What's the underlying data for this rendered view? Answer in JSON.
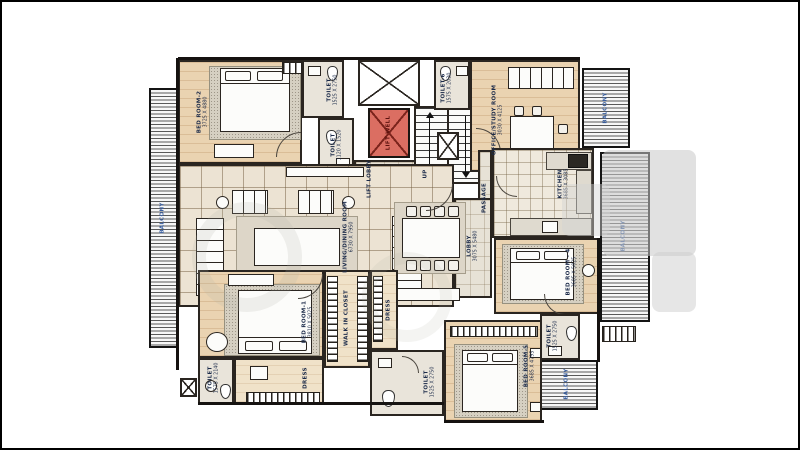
{
  "labels": {
    "balcony_left": {
      "name": "BALCONY"
    },
    "bedroom2": {
      "name": "BED ROOM-2",
      "dims": "3725 X 4880"
    },
    "toilet_top": {
      "name": "TOILET",
      "dims": "1525 X 2750"
    },
    "toilet_small": {
      "name": "TOILET",
      "dims": "1120 X 1520"
    },
    "lift": {
      "name": "LIFT WELL"
    },
    "lift_lobby": {
      "name": "LIFT LOBBY"
    },
    "stairs": {
      "name": "UP"
    },
    "toilet6": {
      "name": "TOILET-6",
      "dims": "1575 X 2030"
    },
    "office": {
      "name": "OFFICE/STUDY ROOM",
      "dims": "3030 X 4125"
    },
    "balcony_top_right": {
      "name": "BALCONY"
    },
    "kitchen": {
      "name": "KITCHEN",
      "dims": "3685 X 3085"
    },
    "passage": {
      "name": "PASSAGE"
    },
    "lobby": {
      "name": "LOBBY",
      "dims": "3075 X 5480"
    },
    "living": {
      "name": "LIVING/DINING ROOM",
      "dims": "6730 X 7950"
    },
    "bedroom1": {
      "name": "BED ROOM-1",
      "dims": "3810 X 5025"
    },
    "toilet_bl": {
      "name": "TOILET",
      "dims": "1575 X 2140"
    },
    "dress1": {
      "name": "DRESS"
    },
    "walkin": {
      "name": "WALK IN CLOSET"
    },
    "dress2": {
      "name": "DRESS"
    },
    "toilet_bc": {
      "name": "TOILET",
      "dims": "1525 X 2750"
    },
    "bedroom5": {
      "name": "BED ROOM-5",
      "dims": "3685 X 4795"
    },
    "bedroom4": {
      "name": "BED ROOM - 4",
      "dims": "3685 X 5025"
    },
    "toilet_r": {
      "name": "TOILET",
      "dims": "1525 X 2750"
    },
    "balcony_right": {
      "name": "BALCONY"
    },
    "balcony_bottom": {
      "name": "BALCONY"
    }
  },
  "colors": {
    "lift_well_fill": "#db6e62",
    "lift_well_cross": "#7c241c",
    "room_label": "#1c2b4a",
    "balcony_label": "#3a5fa0",
    "wall": "#151210"
  }
}
